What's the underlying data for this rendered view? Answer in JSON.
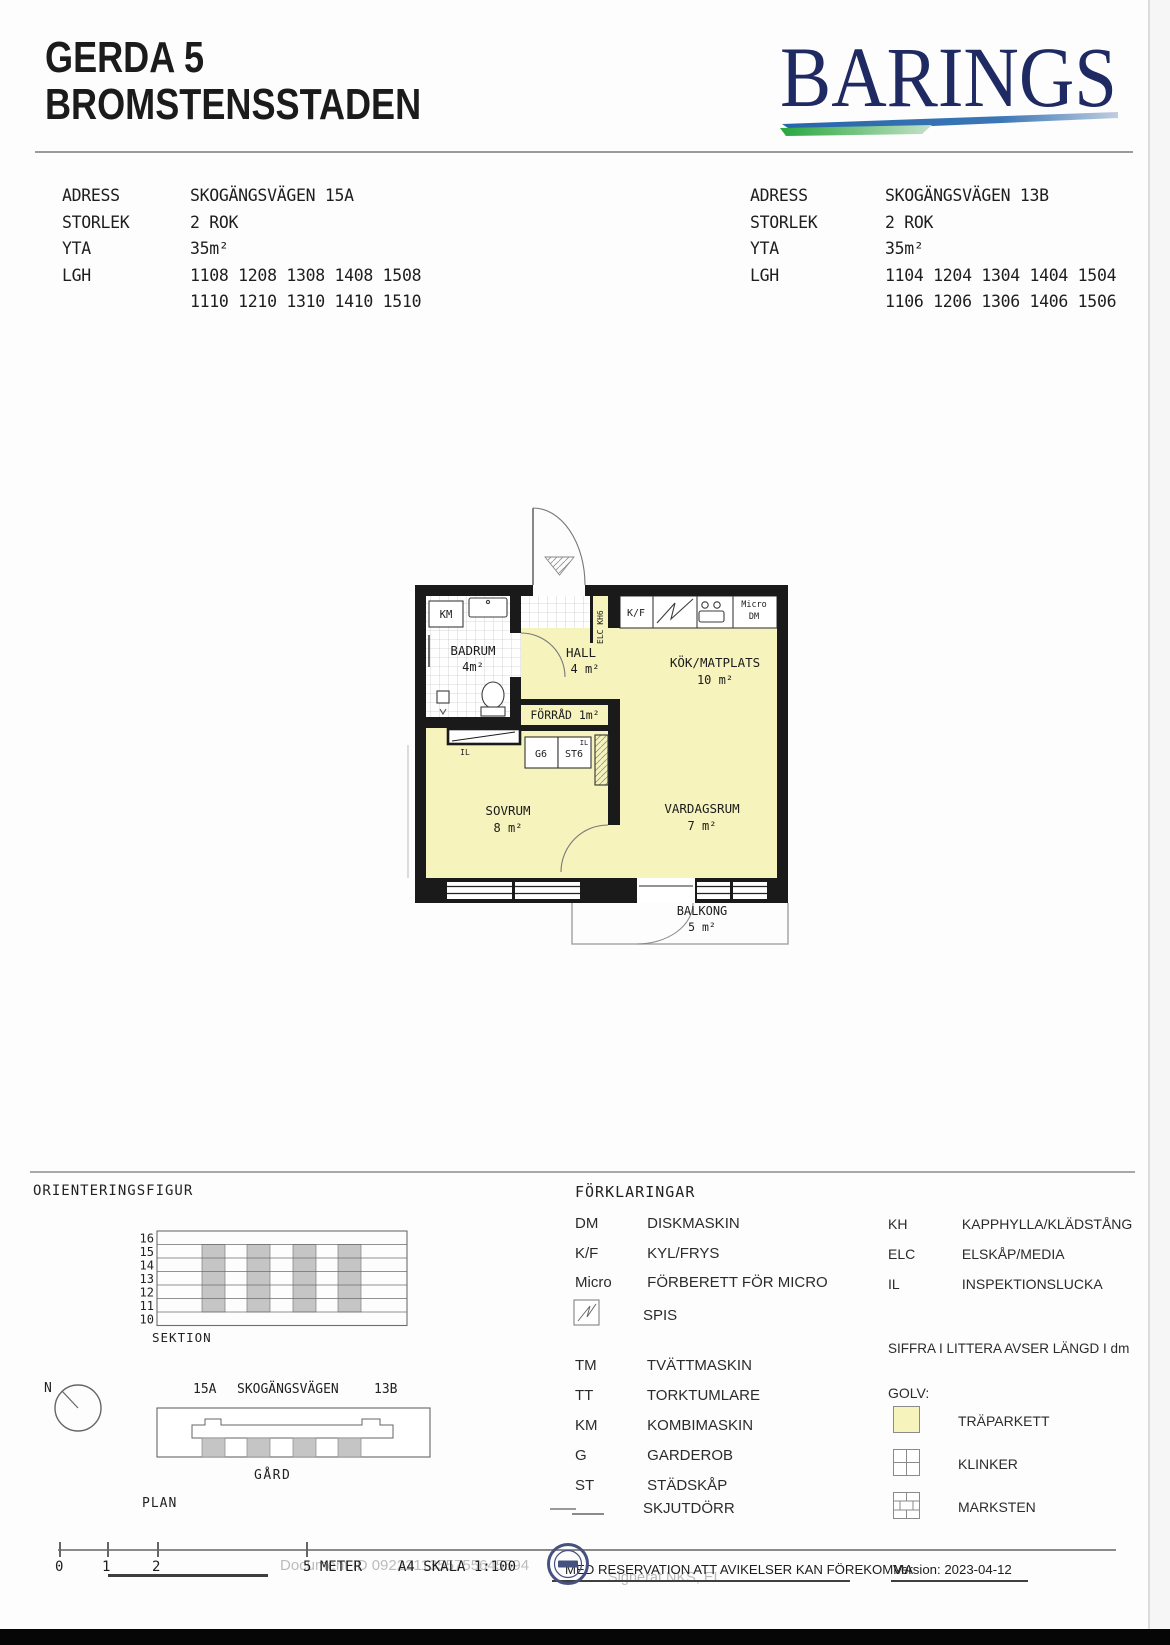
{
  "header": {
    "title_line1": "GERDA 5",
    "title_line2": "BROMSTENSSTADEN",
    "brand": "BARINGS"
  },
  "info_left": {
    "adress_label": "ADRESS",
    "adress": "SKOGÄNGSVÄGEN 15A",
    "storlek_label": "STORLEK",
    "storlek": "2 ROK",
    "yta_label": "YTA",
    "yta": "35m²",
    "lgh_label": "LGH",
    "lgh1": "1108 1208 1308 1408 1508",
    "lgh2": "1110 1210 1310 1410 1510"
  },
  "info_right": {
    "adress_label": "ADRESS",
    "adress": "SKOGÄNGSVÄGEN 13B",
    "storlek_label": "STORLEK",
    "storlek": "2 ROK",
    "yta_label": "YTA",
    "yta": "35m²",
    "lgh_label": "LGH",
    "lgh1": "1104 1204 1304 1404 1504",
    "lgh2": "1106 1206 1306 1406 1506"
  },
  "plan": {
    "badrum": "BADRUM",
    "badrum_area": "4m²",
    "hall": "HALL",
    "hall_area": "4 m²",
    "kok": "KÖK/MATPLATS",
    "kok_area": "10 m²",
    "forrad": "FÖRRÅD 1m²",
    "sovrum": "SOVRUM",
    "sovrum_area": "8 m²",
    "vardagsrum": "VARDAGSRUM",
    "vardagsrum_area": "7 m²",
    "balkong": "BALKONG",
    "balkong_area": "5 m²",
    "km": "KM",
    "kf": "K/F",
    "micro": "Micro",
    "dm": "DM",
    "shaft": "ELC KH6",
    "g6": "G6",
    "st6": "ST6",
    "il": "IL",
    "il2": "IL"
  },
  "orientering": {
    "title": "ORIENTERINGSFIGUR",
    "sektion": "SEKTION",
    "floors": [
      "16",
      "15",
      "14",
      "13",
      "12",
      "11",
      "10"
    ],
    "north": "N",
    "addr_left": "15A",
    "street": "SKOGÄNGSVÄGEN",
    "addr_right": "13B",
    "gard": "GÅRD",
    "plan": "PLAN"
  },
  "legend": {
    "title": "FÖRKLARINGAR",
    "rows_left": [
      {
        "abbr": "DM",
        "desc": "DISKMASKIN"
      },
      {
        "abbr": "K/F",
        "desc": "KYL/FRYS"
      },
      {
        "abbr": "Micro",
        "desc": "FÖRBERETT FÖR MICRO"
      },
      {
        "abbr": "",
        "desc": "SPIS"
      },
      {
        "abbr": "TM",
        "desc": "TVÄTTMASKIN"
      },
      {
        "abbr": "TT",
        "desc": "TORKTUMLARE"
      },
      {
        "abbr": "KM",
        "desc": "KOMBIMASKIN"
      },
      {
        "abbr": "G",
        "desc": "GARDEROB"
      },
      {
        "abbr": "ST",
        "desc": "STÄDSKÅP"
      },
      {
        "abbr": "",
        "desc": "SKJUTDÖRR"
      }
    ],
    "rows_right": [
      {
        "abbr": "KH",
        "desc": "KAPPHYLLA/KLÄDSTÅNG"
      },
      {
        "abbr": "ELC",
        "desc": "ELSKÅP/MEDIA"
      },
      {
        "abbr": "IL",
        "desc": "INSPEKTIONSLUCKA"
      }
    ],
    "note": "SIFFRA I LITTERA AVSER LÄNGD I dm",
    "golv_label": "GOLV:",
    "golv": [
      {
        "name": "TRÄPARKETT"
      },
      {
        "name": "KLINKER"
      },
      {
        "name": "MARKSTEN"
      }
    ]
  },
  "footer": {
    "tick0": "0",
    "tick1": "1",
    "tick2": "2",
    "tick5": "5 METER",
    "skala": "A4 SKALA 1:100",
    "reservation": "MED RESERVATION ATT AVIKELSER KAN FÖREKOMMA",
    "version": "Version: 2023-04-12",
    "doc_id": "Document ID 0922211355755645594",
    "signed": "Signerat NKS, EL"
  },
  "colors": {
    "room_yellow": "#f6f3bd",
    "brand_navy": "#1f2a63",
    "swoosh_blue": "#2f6fb2",
    "swoosh_green": "#2fae3f"
  }
}
